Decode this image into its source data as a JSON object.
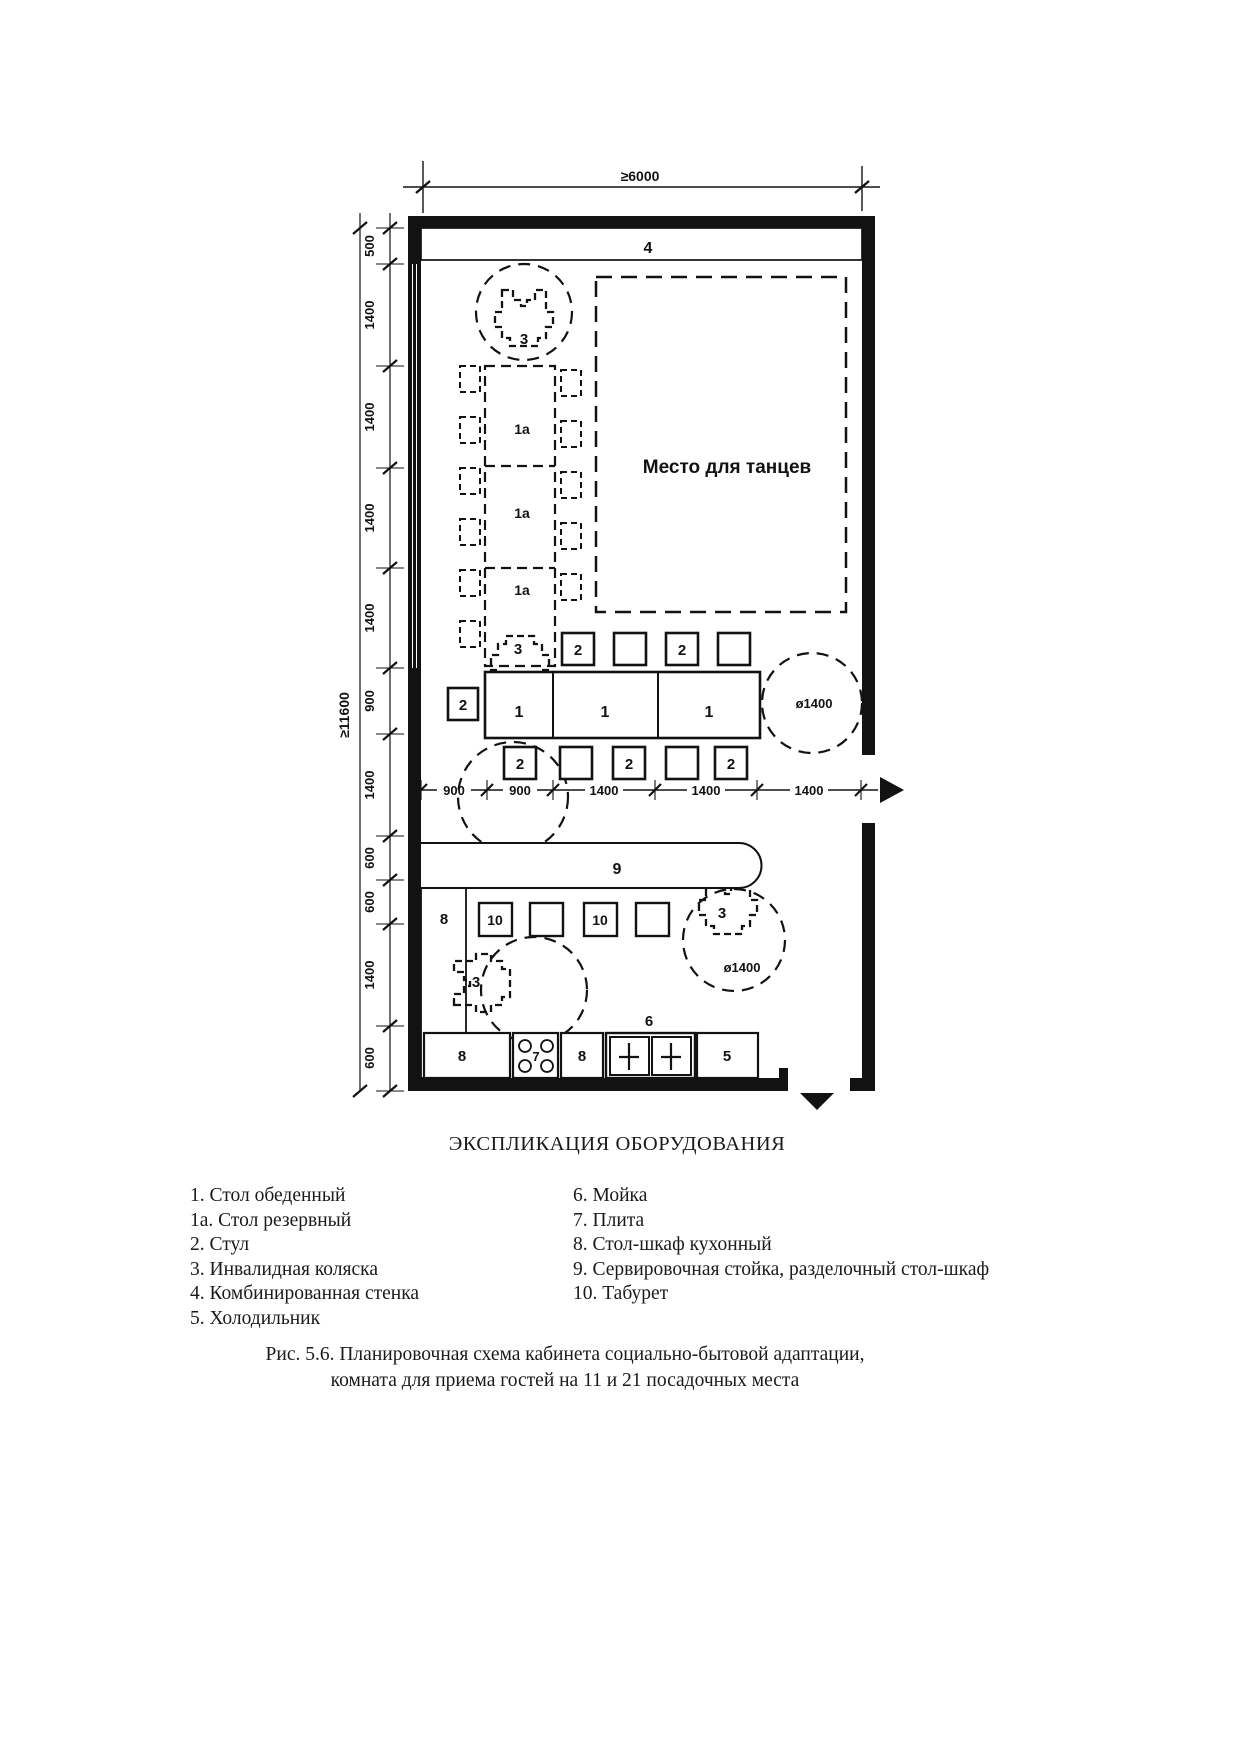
{
  "plan": {
    "dims": {
      "width_total": "≥6000",
      "height_total": "≥11600",
      "left_segments": [
        "500",
        "1400",
        "1400",
        "1400",
        "1400",
        "900",
        "1400",
        "600",
        "600",
        "1400",
        "600"
      ],
      "bottom_segments": [
        "900",
        "900",
        "1400",
        "1400",
        "1400"
      ],
      "turning_circle": "ø1400"
    },
    "labels": {
      "dining_table": "1",
      "reserve_table": "1а",
      "chair": "2",
      "wheelchair": "3",
      "wall_unit": "4",
      "fridge": "5",
      "sink": "6",
      "stove": "7",
      "cabinet": "8",
      "counter": "9",
      "stool": "10",
      "dance_area": "Место для танцев"
    }
  },
  "legend": {
    "title": "ЭКСПЛИКАЦИЯ ОБОРУДОВАНИЯ",
    "left_column": [
      "1. Стол обеденный",
      "1а. Стол резервный",
      "2. Стул",
      "3. Инвалидная коляска",
      "4. Комбинированная стенка",
      "5. Холодильник"
    ],
    "right_column": [
      "6. Мойка",
      "7. Плита",
      "8. Стол-шкаф кухонный",
      "9. Сервировочная стойка, разделочный стол-шкаф",
      "10. Табурет"
    ]
  },
  "caption": {
    "line1": "Рис. 5.6. Планировочная схема кабинета социально-бытовой адаптации,",
    "line2": "комната для приема гостей на 11 и 21 посадочных места"
  }
}
